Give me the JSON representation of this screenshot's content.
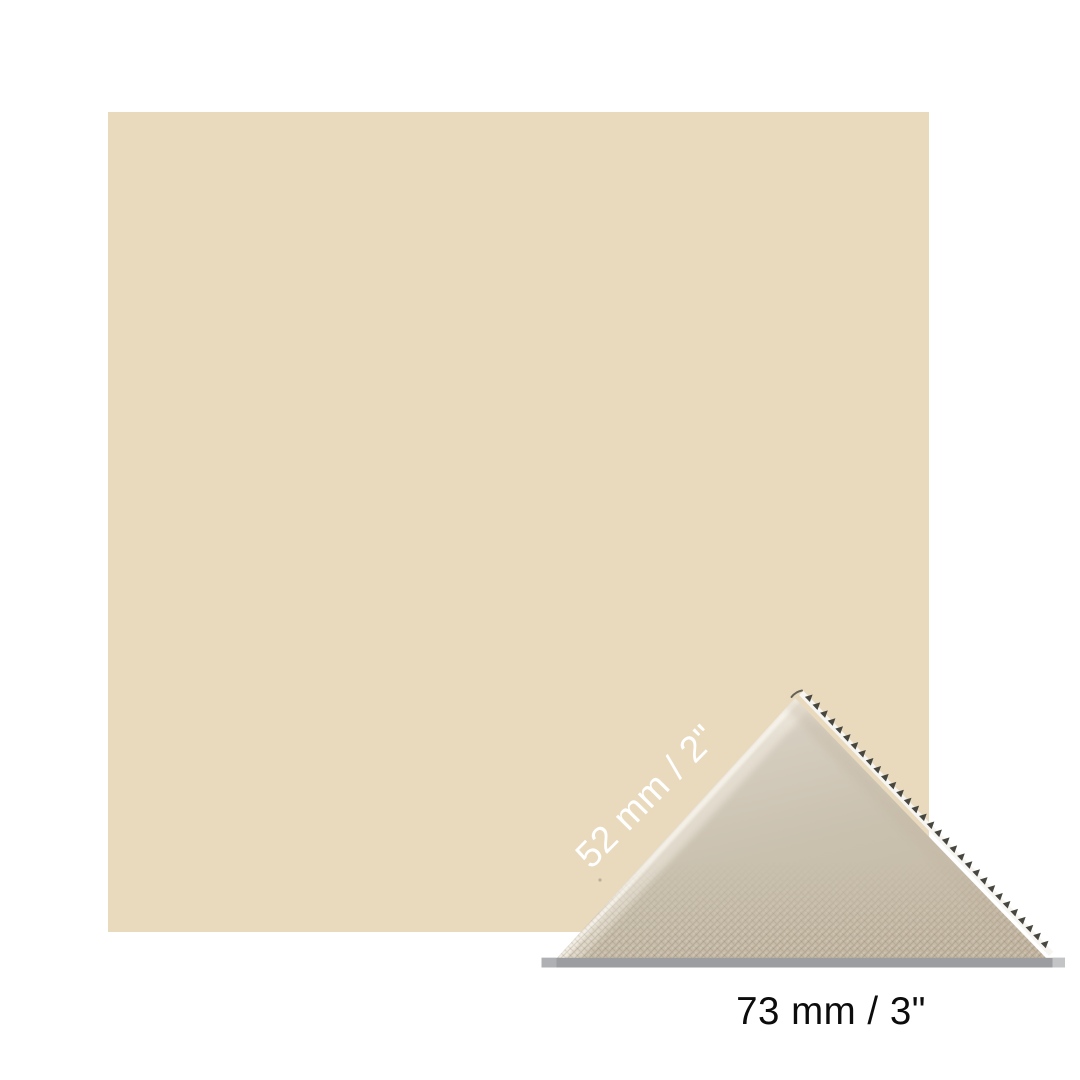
{
  "scene": {
    "background_color": "#FFFFFF"
  },
  "color_swatch": {
    "fill_color": "#E9DABE"
  },
  "fabric_swatch": {
    "apex_color": "#E7E1D4",
    "upper_color": "#D5CDBF",
    "mid_color": "#C9C0AE",
    "bottom_color": "#C5BAA6",
    "pinked_band_color": "#F6F5F1",
    "pinked_teeth_color": "#47463F",
    "base_bar_color": "#9B9DA0",
    "base_bar_left_cap_color": "#AEB0B3",
    "base_bar_right_tip_color": "#C3C4C6"
  },
  "dimension_labels": {
    "hypotenuse": {
      "text": "52 mm / 2\"",
      "color": "#FFFFFF"
    },
    "base": {
      "text": "73 mm / 3\"",
      "color": "#0C0C0C"
    }
  }
}
